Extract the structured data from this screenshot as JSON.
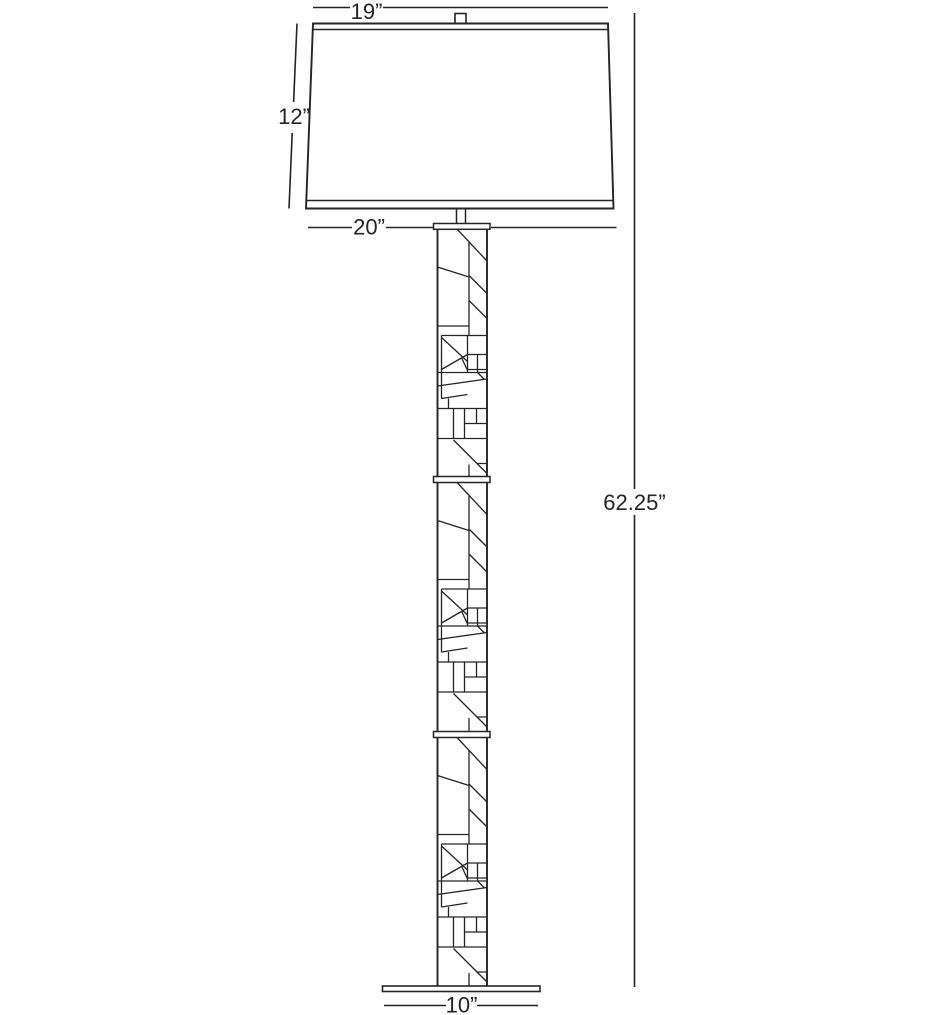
{
  "colors": {
    "line": "#262324",
    "background": "#ffffff"
  },
  "dimensions": {
    "shade_top_width": "19”",
    "shade_height": "12”",
    "shade_bottom_width": "20”",
    "overall_height": "62.25”",
    "base_width": "10”"
  }
}
